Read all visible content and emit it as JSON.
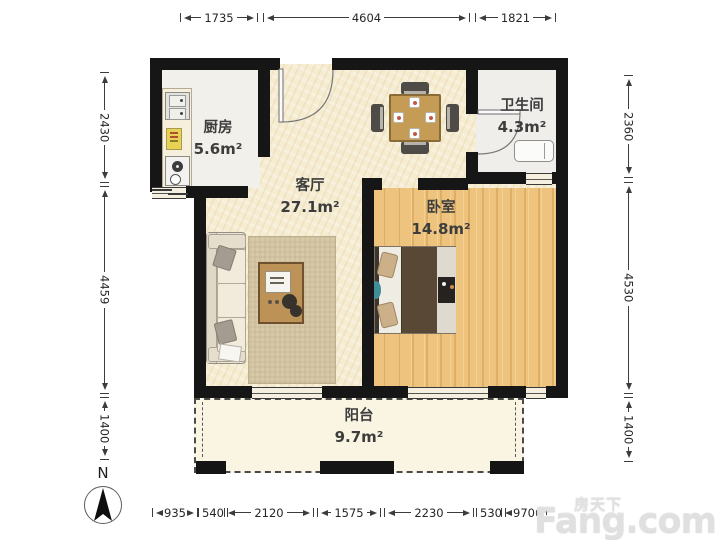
{
  "plan": {
    "type": "apartment-floor-plan"
  },
  "rooms": {
    "kitchen": {
      "name": "厨房",
      "area": "5.6m²"
    },
    "living": {
      "name": "客厅",
      "area": "27.1m²"
    },
    "bathroom": {
      "name": "卫生间",
      "area": "4.3m²"
    },
    "bedroom": {
      "name": "卧室",
      "area": "14.8m²"
    },
    "balcony": {
      "name": "阳台",
      "area": "9.7m²"
    }
  },
  "dimensions_mm": {
    "top": [
      "1735",
      "4604",
      "1821"
    ],
    "left": [
      "2430",
      "4459",
      "1400"
    ],
    "right": [
      "2360",
      "4530",
      "1400"
    ],
    "bottom": [
      "935",
      "540",
      "2120",
      "1575",
      "2230",
      "530",
      "970"
    ]
  },
  "compass": {
    "label": "N"
  },
  "watermark": {
    "site_cn": "房天下",
    "site_en": "Fang.com"
  },
  "colors": {
    "wall": "#161616",
    "living_floor": "#f5ecd1",
    "wood_floor": "#eabf79",
    "accent_teal": "#3f8d99"
  }
}
